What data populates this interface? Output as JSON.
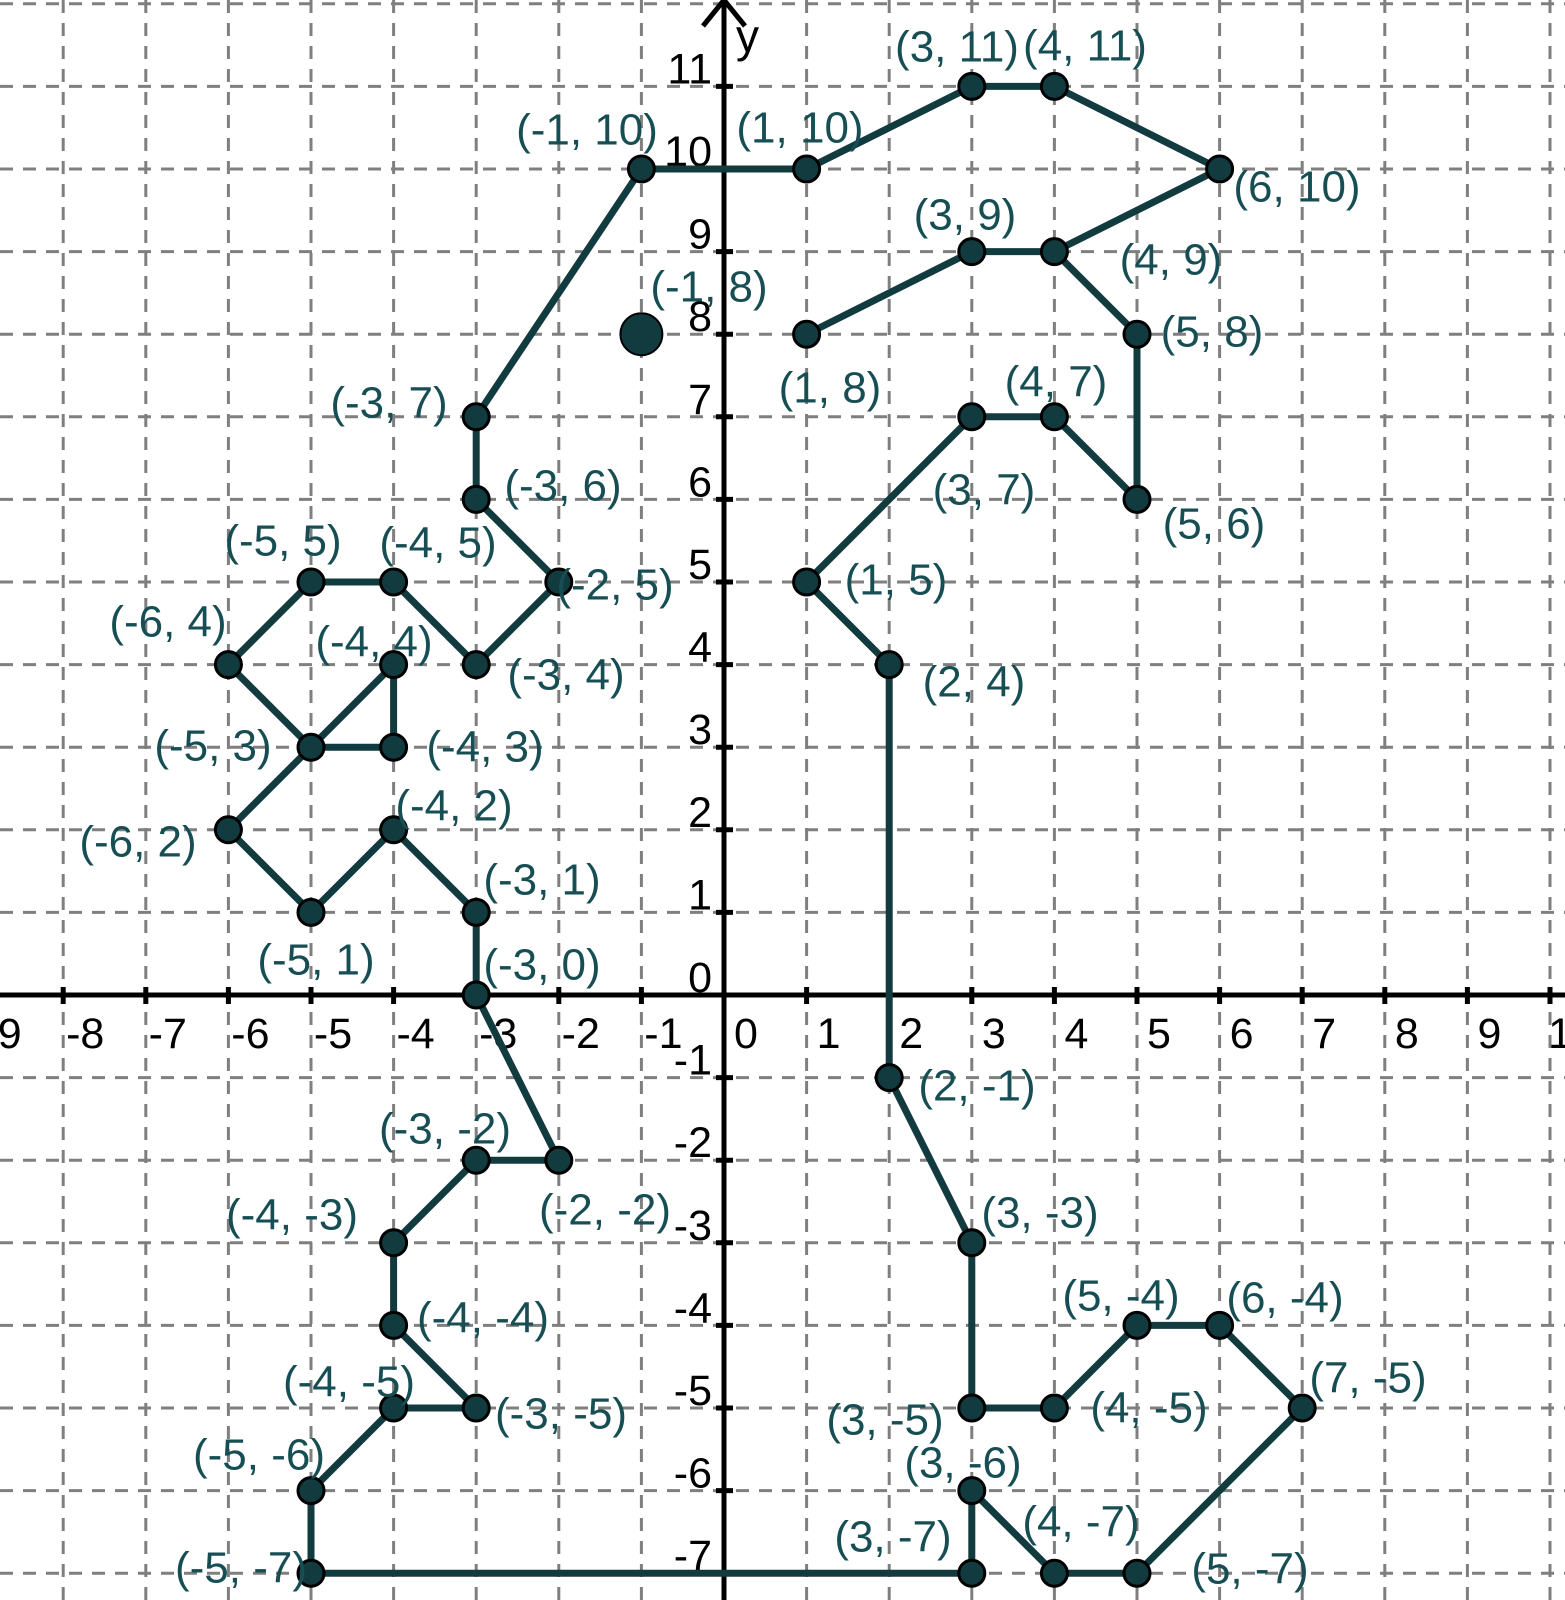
{
  "figure": {
    "background": "#ffffff",
    "colors": {
      "shape_line": "#113b3f",
      "point_fill": "#113b3f",
      "point_stroke": "#000000",
      "label_text": "#174e54",
      "grid_line": "#7f7f7f",
      "axis_line": "#000000"
    },
    "axes": {
      "y_axis_label": "y",
      "x_tick_labels": [
        "-9",
        "-8",
        "-7",
        "-6",
        "-5",
        "-4",
        "-3",
        "-2",
        "-1",
        "0",
        "1",
        "2",
        "3",
        "4",
        "5",
        "6",
        "7",
        "8",
        "9",
        "10"
      ],
      "y_tick_labels": [
        "-7",
        "-6",
        "-5",
        "-4",
        "-3",
        "-2",
        "-1",
        "0",
        "1",
        "2",
        "3",
        "4",
        "5",
        "6",
        "7",
        "8",
        "9",
        "10",
        "11"
      ]
    }
  },
  "chart_data": {
    "type": "scatter",
    "title": "",
    "xlabel": "",
    "ylabel": "y",
    "x_range": [
      -9,
      10
    ],
    "y_range": [
      -7,
      12
    ],
    "grid": true,
    "description": "Connect-the-dots outline drawing (seahorse) on a dashed coordinate grid; every vertex is a labeled point and a large filled dot at (-1, 8) forms the eye.",
    "points": [
      {
        "x": -1,
        "y": 10,
        "label": "(-1, 10)",
        "label_px": [
          587,
          130
        ]
      },
      {
        "x": 1,
        "y": 10,
        "label": "(1, 10)",
        "label_px": [
          800,
          128
        ]
      },
      {
        "x": 3,
        "y": 11,
        "label": "(3, 11)",
        "label_px": [
          957,
          47
        ]
      },
      {
        "x": 4,
        "y": 11,
        "label": "(4, 11)",
        "label_px": [
          1085,
          46
        ]
      },
      {
        "x": 6,
        "y": 10,
        "label": "(6, 10)",
        "label_px": [
          1297,
          187
        ]
      },
      {
        "x": 3,
        "y": 9,
        "label": "(3, 9)",
        "label_px": [
          965,
          215
        ]
      },
      {
        "x": 4,
        "y": 9,
        "label": "(4, 9)",
        "label_px": [
          1171,
          260
        ]
      },
      {
        "x": 1,
        "y": 8,
        "label": "(1, 8)",
        "label_px": [
          830,
          388
        ]
      },
      {
        "x": 5,
        "y": 8,
        "label": "(5, 8)",
        "label_px": [
          1212,
          332
        ]
      },
      {
        "x": 4,
        "y": 7,
        "label": "(4, 7)",
        "label_px": [
          1056,
          382
        ]
      },
      {
        "x": 3,
        "y": 7,
        "label": "(3, 7)",
        "label_px": [
          984,
          490
        ]
      },
      {
        "x": 5,
        "y": 6,
        "label": "(5, 6)",
        "label_px": [
          1214,
          524
        ]
      },
      {
        "x": 1,
        "y": 5,
        "label": "(1, 5)",
        "label_px": [
          896,
          580
        ]
      },
      {
        "x": 2,
        "y": 4,
        "label": "(2, 4)",
        "label_px": [
          974,
          682
        ]
      },
      {
        "x": -3,
        "y": 7,
        "label": "(-3, 7)",
        "label_px": [
          389,
          403
        ]
      },
      {
        "x": -3,
        "y": 6,
        "label": "(-3, 6)",
        "label_px": [
          563,
          486
        ]
      },
      {
        "x": -2,
        "y": 5,
        "label": "(-2, 5)",
        "label_px": [
          615,
          585
        ]
      },
      {
        "x": -5,
        "y": 5,
        "label": "(-5, 5)",
        "label_px": [
          283,
          541
        ]
      },
      {
        "x": -4,
        "y": 5,
        "label": "(-4, 5)",
        "label_px": [
          438,
          543
        ]
      },
      {
        "x": -6,
        "y": 4,
        "label": "(-6, 4)",
        "label_px": [
          168,
          622
        ]
      },
      {
        "x": -4,
        "y": 4,
        "label": "(-4, 4)",
        "label_px": [
          374,
          642
        ]
      },
      {
        "x": -3,
        "y": 4,
        "label": "(-3, 4)",
        "label_px": [
          566,
          675
        ]
      },
      {
        "x": -5,
        "y": 3,
        "label": "(-5, 3)",
        "label_px": [
          213,
          746
        ]
      },
      {
        "x": -4,
        "y": 3,
        "label": "(-4, 3)",
        "label_px": [
          485,
          747
        ]
      },
      {
        "x": -4,
        "y": 2,
        "label": "(-4, 2)",
        "label_px": [
          454,
          806
        ]
      },
      {
        "x": -6,
        "y": 2,
        "label": "(-6, 2)",
        "label_px": [
          138,
          842
        ]
      },
      {
        "x": -3,
        "y": 1,
        "label": "(-3, 1)",
        "label_px": [
          542,
          880
        ]
      },
      {
        "x": -5,
        "y": 1,
        "label": "(-5, 1)",
        "label_px": [
          316,
          960
        ]
      },
      {
        "x": -3,
        "y": 0,
        "label": "(-3, 0)",
        "label_px": [
          542,
          965
        ]
      },
      {
        "x": 2,
        "y": -1,
        "label": "(2, -1)",
        "label_px": [
          977,
          1086
        ]
      },
      {
        "x": -3,
        "y": -2,
        "label": "(-3, -2)",
        "label_px": [
          445,
          1129
        ]
      },
      {
        "x": -2,
        "y": -2,
        "label": "(-2, -2)",
        "label_px": [
          605,
          1210
        ]
      },
      {
        "x": 3,
        "y": -3,
        "label": "(3, -3)",
        "label_px": [
          1040,
          1213
        ]
      },
      {
        "x": -4,
        "y": -3,
        "label": "(-4, -3)",
        "label_px": [
          292,
          1215
        ]
      },
      {
        "x": -4,
        "y": -4,
        "label": "(-4, -4)",
        "label_px": [
          483,
          1318
        ]
      },
      {
        "x": 5,
        "y": -4,
        "label": "(5, -4)",
        "label_px": [
          1121,
          1296
        ]
      },
      {
        "x": 6,
        "y": -4,
        "label": "(6, -4)",
        "label_px": [
          1285,
          1298
        ]
      },
      {
        "x": 7,
        "y": -5,
        "label": "(7, -5)",
        "label_px": [
          1368,
          1378
        ]
      },
      {
        "x": -4,
        "y": -5,
        "label": "(-4, -5)",
        "label_px": [
          349,
          1382
        ]
      },
      {
        "x": -3,
        "y": -5,
        "label": "(-3, -5)",
        "label_px": [
          561,
          1414
        ]
      },
      {
        "x": 3,
        "y": -5,
        "label": "(3, -5)",
        "label_px": [
          885,
          1420
        ]
      },
      {
        "x": 4,
        "y": -5,
        "label": "(4, -5)",
        "label_px": [
          1149,
          1408
        ]
      },
      {
        "x": -5,
        "y": -6,
        "label": "(-5, -6)",
        "label_px": [
          259,
          1455
        ]
      },
      {
        "x": 3,
        "y": -6,
        "label": "(3, -6)",
        "label_px": [
          963,
          1463
        ]
      },
      {
        "x": -5,
        "y": -7,
        "label": "(-5, -7)",
        "label_px": [
          241,
          1568
        ]
      },
      {
        "x": 3,
        "y": -7,
        "label": "(3, -7)",
        "label_px": [
          893,
          1537
        ]
      },
      {
        "x": 4,
        "y": -7,
        "label": "(4, -7)",
        "label_px": [
          1081,
          1522
        ]
      },
      {
        "x": 5,
        "y": -7,
        "label": "(5, -7)",
        "label_px": [
          1250,
          1569
        ]
      }
    ],
    "eye_point": {
      "x": -1,
      "y": 8,
      "label": "(-1, 8)",
      "label_px": [
        709,
        287
      ]
    },
    "segments": [
      [
        [
          1,
          8
        ],
        [
          3,
          9
        ]
      ],
      [
        [
          3,
          9
        ],
        [
          4,
          9
        ]
      ],
      [
        [
          4,
          9
        ],
        [
          6,
          10
        ]
      ],
      [
        [
          6,
          10
        ],
        [
          4,
          11
        ]
      ],
      [
        [
          4,
          11
        ],
        [
          3,
          11
        ]
      ],
      [
        [
          3,
          11
        ],
        [
          1,
          10
        ]
      ],
      [
        [
          1,
          10
        ],
        [
          -1,
          10
        ]
      ],
      [
        [
          -1,
          10
        ],
        [
          -3,
          7
        ]
      ],
      [
        [
          -3,
          7
        ],
        [
          -3,
          6
        ]
      ],
      [
        [
          -3,
          6
        ],
        [
          -2,
          5
        ]
      ],
      [
        [
          -2,
          5
        ],
        [
          -3,
          4
        ]
      ],
      [
        [
          -3,
          4
        ],
        [
          -4,
          5
        ]
      ],
      [
        [
          -4,
          5
        ],
        [
          -5,
          5
        ]
      ],
      [
        [
          -5,
          5
        ],
        [
          -6,
          4
        ]
      ],
      [
        [
          -6,
          4
        ],
        [
          -5,
          3
        ]
      ],
      [
        [
          -5,
          3
        ],
        [
          -4,
          4
        ]
      ],
      [
        [
          -4,
          4
        ],
        [
          -4,
          3
        ]
      ],
      [
        [
          -4,
          3
        ],
        [
          -5,
          3
        ]
      ],
      [
        [
          -5,
          3
        ],
        [
          -6,
          2
        ]
      ],
      [
        [
          -6,
          2
        ],
        [
          -5,
          1
        ]
      ],
      [
        [
          -5,
          1
        ],
        [
          -4,
          2
        ]
      ],
      [
        [
          -4,
          2
        ],
        [
          -3,
          1
        ]
      ],
      [
        [
          -3,
          1
        ],
        [
          -3,
          0
        ]
      ],
      [
        [
          -3,
          0
        ],
        [
          -2,
          -2
        ]
      ],
      [
        [
          -2,
          -2
        ],
        [
          -3,
          -2
        ]
      ],
      [
        [
          -3,
          -2
        ],
        [
          -4,
          -3
        ]
      ],
      [
        [
          -4,
          -3
        ],
        [
          -4,
          -4
        ]
      ],
      [
        [
          -4,
          -4
        ],
        [
          -3,
          -5
        ]
      ],
      [
        [
          -3,
          -5
        ],
        [
          -4,
          -5
        ]
      ],
      [
        [
          -4,
          -5
        ],
        [
          -5,
          -6
        ]
      ],
      [
        [
          -5,
          -6
        ],
        [
          -5,
          -7
        ]
      ],
      [
        [
          -5,
          -7
        ],
        [
          3,
          -7
        ]
      ],
      [
        [
          3,
          -7
        ],
        [
          3,
          -6
        ]
      ],
      [
        [
          3,
          -6
        ],
        [
          4,
          -7
        ]
      ],
      [
        [
          4,
          -7
        ],
        [
          5,
          -7
        ]
      ],
      [
        [
          5,
          -7
        ],
        [
          7,
          -5
        ]
      ],
      [
        [
          7,
          -5
        ],
        [
          6,
          -4
        ]
      ],
      [
        [
          6,
          -4
        ],
        [
          5,
          -4
        ]
      ],
      [
        [
          5,
          -4
        ],
        [
          4,
          -5
        ]
      ],
      [
        [
          4,
          -5
        ],
        [
          3,
          -5
        ]
      ],
      [
        [
          3,
          -5
        ],
        [
          3,
          -3
        ]
      ],
      [
        [
          3,
          -3
        ],
        [
          2,
          -1
        ]
      ],
      [
        [
          2,
          -1
        ],
        [
          2,
          4
        ]
      ],
      [
        [
          2,
          4
        ],
        [
          1,
          5
        ]
      ],
      [
        [
          1,
          5
        ],
        [
          3,
          7
        ]
      ],
      [
        [
          3,
          7
        ],
        [
          4,
          7
        ]
      ],
      [
        [
          4,
          7
        ],
        [
          5,
          6
        ]
      ],
      [
        [
          5,
          6
        ],
        [
          5,
          8
        ]
      ],
      [
        [
          5,
          8
        ],
        [
          4,
          9
        ]
      ]
    ]
  }
}
